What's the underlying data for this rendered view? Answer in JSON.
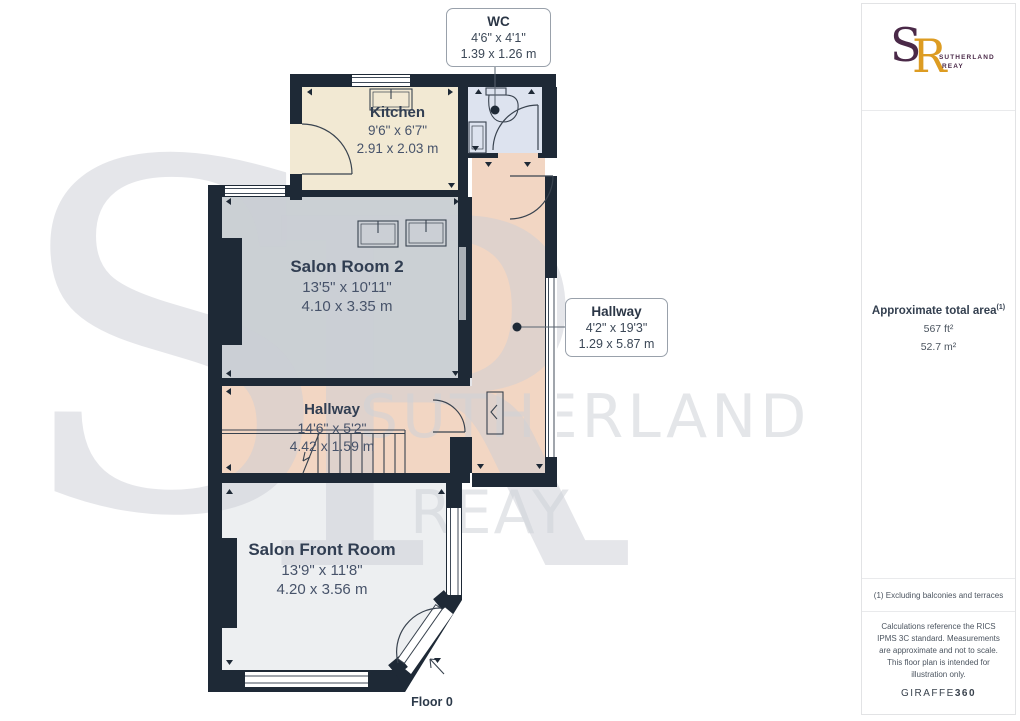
{
  "plan": {
    "floor_label": "Floor 0",
    "rooms": [
      {
        "id": "wc",
        "name": "WC",
        "dims_imperial": "4'6\" x 4'1\"",
        "dims_metric": "1.39 x 1.26 m"
      },
      {
        "id": "kitchen",
        "name": "Kitchen",
        "dims_imperial": "9'6\" x 6'7\"",
        "dims_metric": "2.91 x 2.03 m"
      },
      {
        "id": "salon-room-2",
        "name": "Salon Room 2",
        "dims_imperial": "13'5\" x 10'11\"",
        "dims_metric": "4.10 x 3.35 m"
      },
      {
        "id": "hallway-vertical",
        "name": "Hallway",
        "dims_imperial": "4'2\" x 19'3\"",
        "dims_metric": "1.29 x 5.87 m"
      },
      {
        "id": "hallway",
        "name": "Hallway",
        "dims_imperial": "14'6\" x 5'2\"",
        "dims_metric": "4.42 x 1.59 m"
      },
      {
        "id": "salon-front-room",
        "name": "Salon Front Room",
        "dims_imperial": "13'9\" x 11'8\"",
        "dims_metric": "4.20 x 3.56 m"
      }
    ]
  },
  "watermark": {
    "monogram_s": "S",
    "monogram_r": "R",
    "line1": "SUTHERLAND",
    "line2": "REAY"
  },
  "sidebar": {
    "logo": {
      "monogram_s": "S",
      "monogram_r": "R",
      "name_line1": "SUTHERLAND",
      "name_line2": "REAY"
    },
    "area": {
      "title": "Approximate total area",
      "sup": "(1)",
      "imperial": "567 ft²",
      "metric": "52.7 m²"
    },
    "footnote": "(1) Excluding balconies and terraces",
    "disclaimer": "Calculations reference the RICS IPMS 3C standard. Measurements are approximate and not to scale. This floor plan is intended for illustration only.",
    "brand": {
      "giraffe": "GIRAFFE",
      "num": "360"
    }
  },
  "colors": {
    "wall": "#1e2936",
    "kitchen_floor": "#f2e9d3",
    "wc_floor": "#dde3ef",
    "hallway_floor": "#f2d6c3",
    "salon_room_floor": "#cbd0d4",
    "front_room_floor": "#edeff1",
    "logo_purple": "#4a2948",
    "logo_gold": "#dd9c22",
    "watermark_gray": "#d4d7dd"
  }
}
